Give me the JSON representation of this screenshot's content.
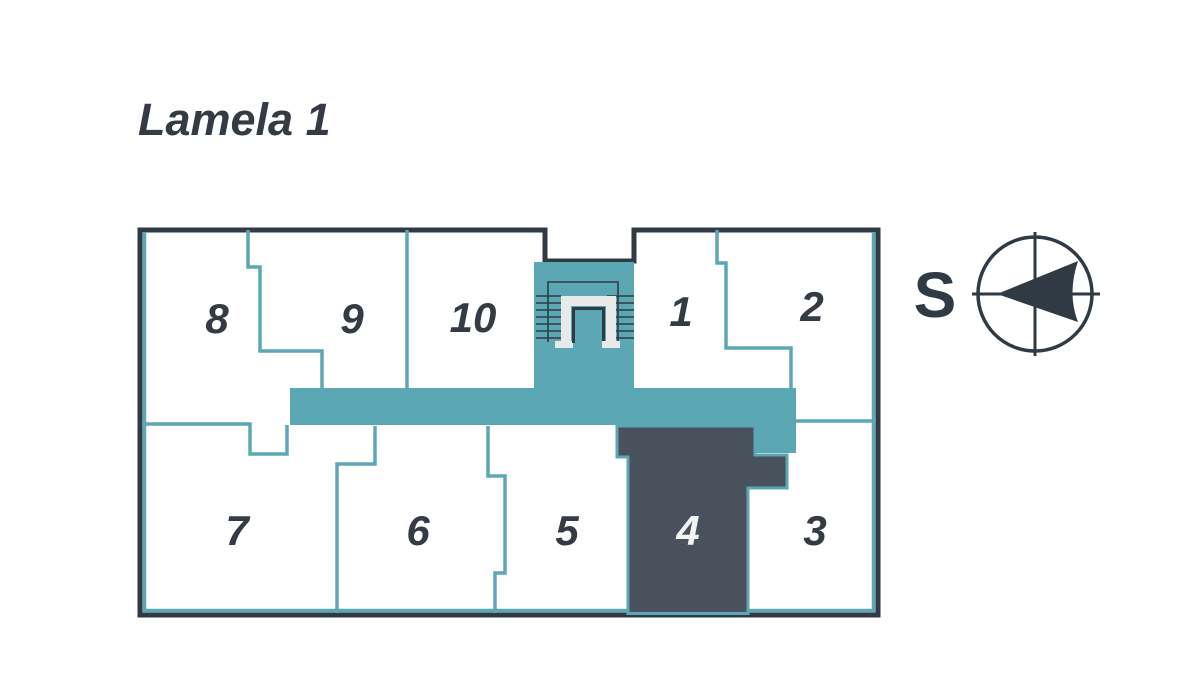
{
  "title": "Lamela 1",
  "compass": {
    "label": "S"
  },
  "units": [
    {
      "label": "1",
      "highlighted": false
    },
    {
      "label": "2",
      "highlighted": false
    },
    {
      "label": "3",
      "highlighted": false
    },
    {
      "label": "4",
      "highlighted": true
    },
    {
      "label": "5",
      "highlighted": false
    },
    {
      "label": "6",
      "highlighted": false
    },
    {
      "label": "7",
      "highlighted": false
    },
    {
      "label": "8",
      "highlighted": false
    },
    {
      "label": "9",
      "highlighted": false
    },
    {
      "label": "10",
      "highlighted": false
    }
  ],
  "colors": {
    "teal": "#5BA7B3",
    "wall": "#2F3A45",
    "highlight": "#49515C",
    "ink": "#343B45",
    "hltext": "#F2F3F3",
    "ulight": "#E8EAEA"
  }
}
